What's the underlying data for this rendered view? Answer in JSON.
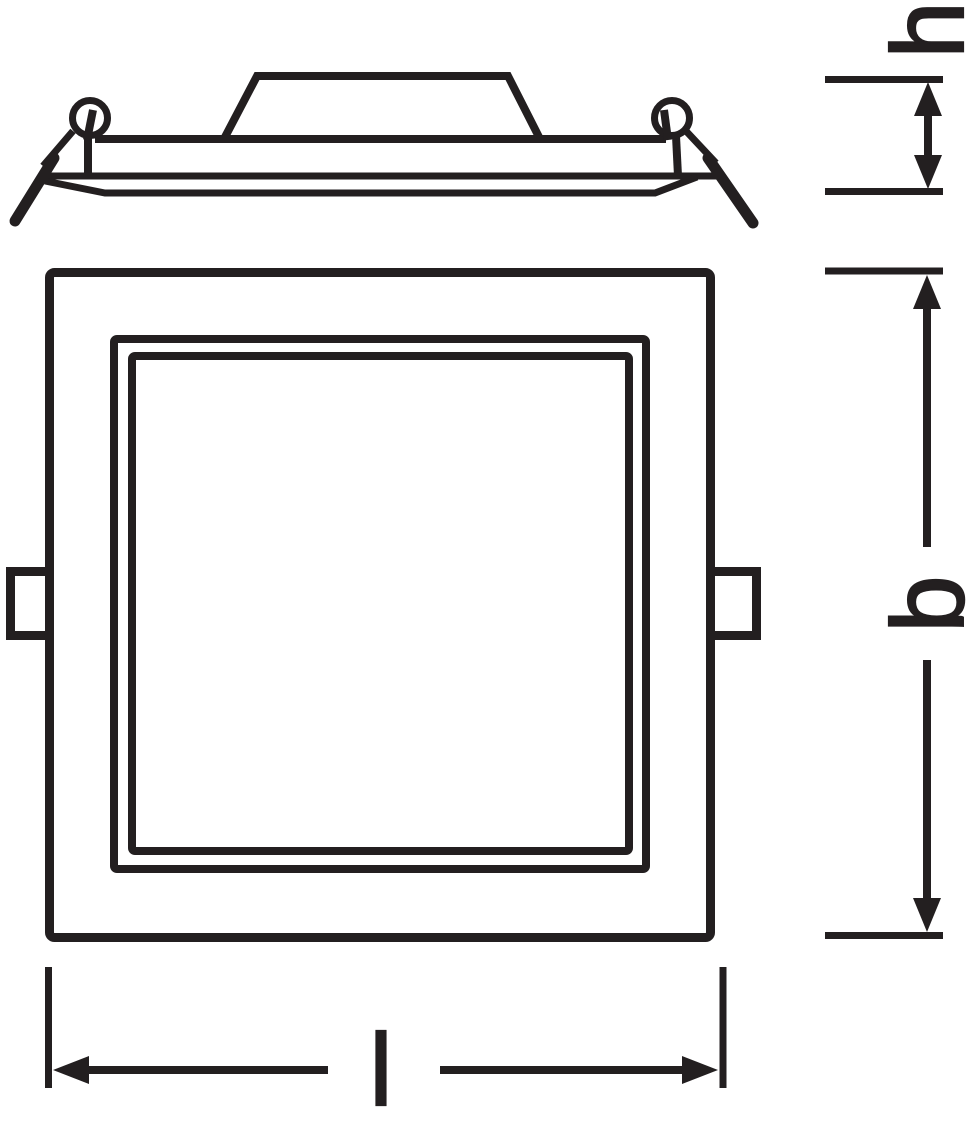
{
  "drawing": {
    "background_color": "#ffffff",
    "ink_color": "#231f20",
    "dimension_labels": {
      "h": "h",
      "b": "b",
      "l": "l"
    }
  }
}
